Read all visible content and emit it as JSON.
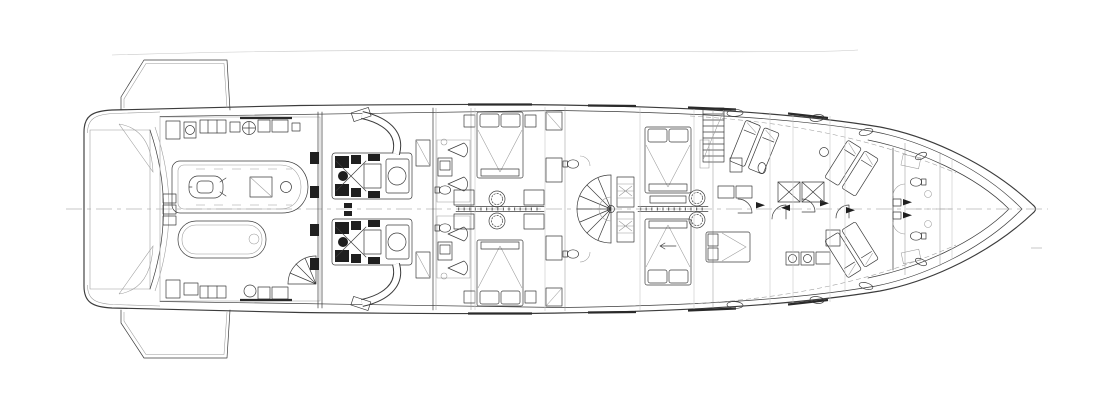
{
  "meta": {
    "description": "Naval-architecture CAD drawing: lower-deck general arrangement plan of a motor yacht, top view, bow to the right, stern swim platform to the left. Line drawing only, no text labels rendered.",
    "drawing_type": "yacht-lower-deck-general-arrangement",
    "orientation": "bow-right"
  },
  "colors": {
    "background": "#ffffff",
    "line": "#3c3c3c",
    "faint_line": "#9a9a9a",
    "extra_faint_line": "#c6c6c6",
    "dark_fill": "#1f1f1f",
    "teak_line": "#8a8a8a",
    "centerline": "#b5b5b5"
  },
  "regions": {
    "stern_platform": {
      "name": "swim-platform",
      "finish": "teak-planking",
      "fold_down_terraces": 2
    },
    "garage": {
      "name": "tender-garage",
      "tenders": 2,
      "jet_ski": 1,
      "aft_spiral_stair": 1
    },
    "engine_room": {
      "name": "engine-room",
      "main_engines": 2,
      "exhaust_pipes": 2,
      "day_tanks": 2
    },
    "guest_area": {
      "name": "guest-cabins",
      "double_beds": 2,
      "bathrooms": 2,
      "lobby_stools": 2
    },
    "vip_area": {
      "name": "vip-cabins",
      "double_beds": 2,
      "spiral_staircase": 1,
      "wardrobes": 2
    },
    "crew_area": {
      "name": "crew-quarters",
      "straight_staircase": 1,
      "mess_tables": 2,
      "bunk_cabins": 1,
      "laundry_machines": 2
    },
    "bow_area": {
      "name": "forepeak-crew-cabins",
      "bunk_pairs": 2,
      "bathrooms": 2,
      "windlass_arrows": 2
    }
  },
  "symbols": [
    "centerline-dashed",
    "door-swing-arc",
    "shower-cone",
    "toilet",
    "washbasin",
    "spiral-stair-fan",
    "crossed-table",
    "porthole-oval",
    "hull-window-strip"
  ]
}
